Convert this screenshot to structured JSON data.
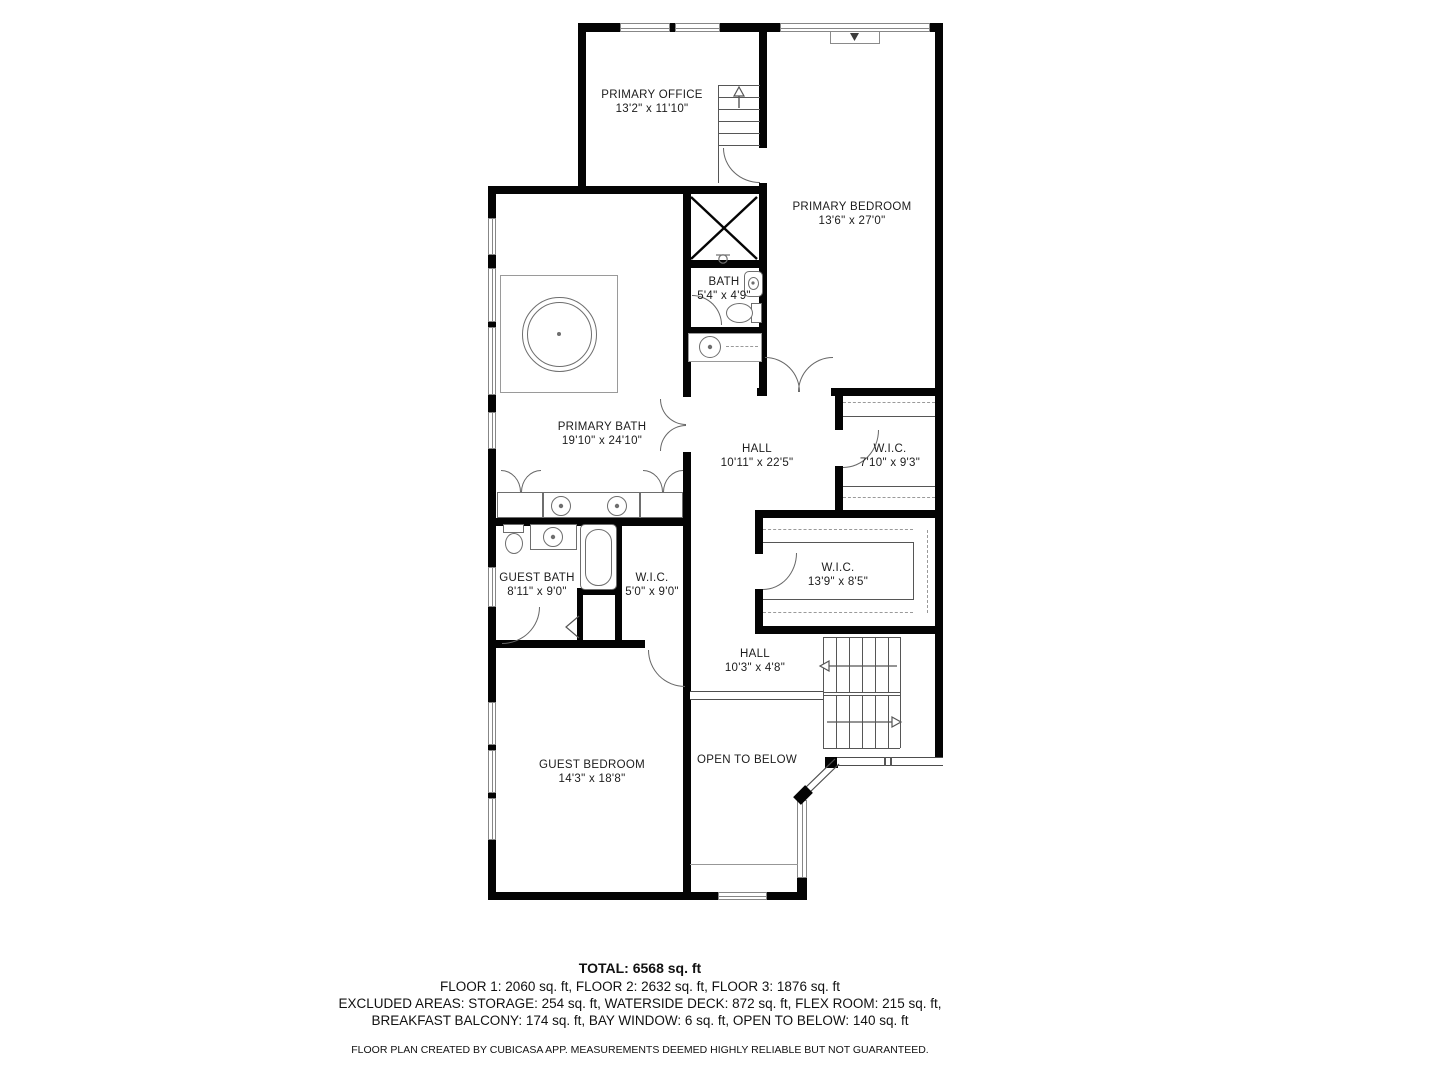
{
  "rooms": [
    {
      "id": "primary-office",
      "name": "PRIMARY OFFICE",
      "dims": "13'2\" x 11'10\""
    },
    {
      "id": "primary-bedroom",
      "name": "PRIMARY BEDROOM",
      "dims": "13'6\" x 27'0\""
    },
    {
      "id": "bath",
      "name": "BATH",
      "dims": "5'4\" x 4'9\""
    },
    {
      "id": "primary-bath",
      "name": "PRIMARY BATH",
      "dims": "19'10\" x 24'10\""
    },
    {
      "id": "hall-upper",
      "name": "HALL",
      "dims": "10'11\" x 22'5\""
    },
    {
      "id": "wic-right",
      "name": "W.I.C.",
      "dims": "7'10\" x 9'3\""
    },
    {
      "id": "wic-13",
      "name": "W.I.C.",
      "dims": "13'9\" x 8'5\""
    },
    {
      "id": "guest-bath",
      "name": "GUEST BATH",
      "dims": "8'11\" x 9'0\""
    },
    {
      "id": "wic-5",
      "name": "W.I.C.",
      "dims": "5'0\" x 9'0\""
    },
    {
      "id": "hall-lower",
      "name": "HALL",
      "dims": "10'3\" x 4'8\""
    },
    {
      "id": "guest-bedroom",
      "name": "GUEST BEDROOM",
      "dims": "14'3\" x 18'8\""
    },
    {
      "id": "open-to-below",
      "name": "OPEN TO BELOW",
      "dims": ""
    }
  ],
  "footer": {
    "total": "TOTAL: 6568 sq. ft",
    "floors": "FLOOR 1: 2060 sq. ft, FLOOR 2: 2632 sq. ft, FLOOR 3: 1876 sq. ft",
    "excluded1": "EXCLUDED AREAS: STORAGE: 254 sq. ft, WATERSIDE DECK: 872 sq. ft, FLEX ROOM: 215 sq. ft,",
    "excluded2": "BREAKFAST BALCONY: 174 sq. ft, BAY WINDOW: 6 sq. ft, OPEN TO BELOW: 140 sq. ft",
    "disclaimer": "FLOOR PLAN CREATED BY CUBICASA APP. MEASUREMENTS DEEMED HIGHLY RELIABLE BUT NOT GUARANTEED."
  },
  "colors": {
    "wall": "#040404",
    "background": "#ffffff",
    "fixture_stroke": "#6e6e6e",
    "rail": "#4d4d4d"
  },
  "fixtures": [
    "round-soaking-tub",
    "vanity-double-sink",
    "pedestal-sink",
    "toilet",
    "bathtub",
    "staircase-up",
    "staircase-main",
    "elevator-shaft",
    "railing",
    "window",
    "door-swing"
  ]
}
